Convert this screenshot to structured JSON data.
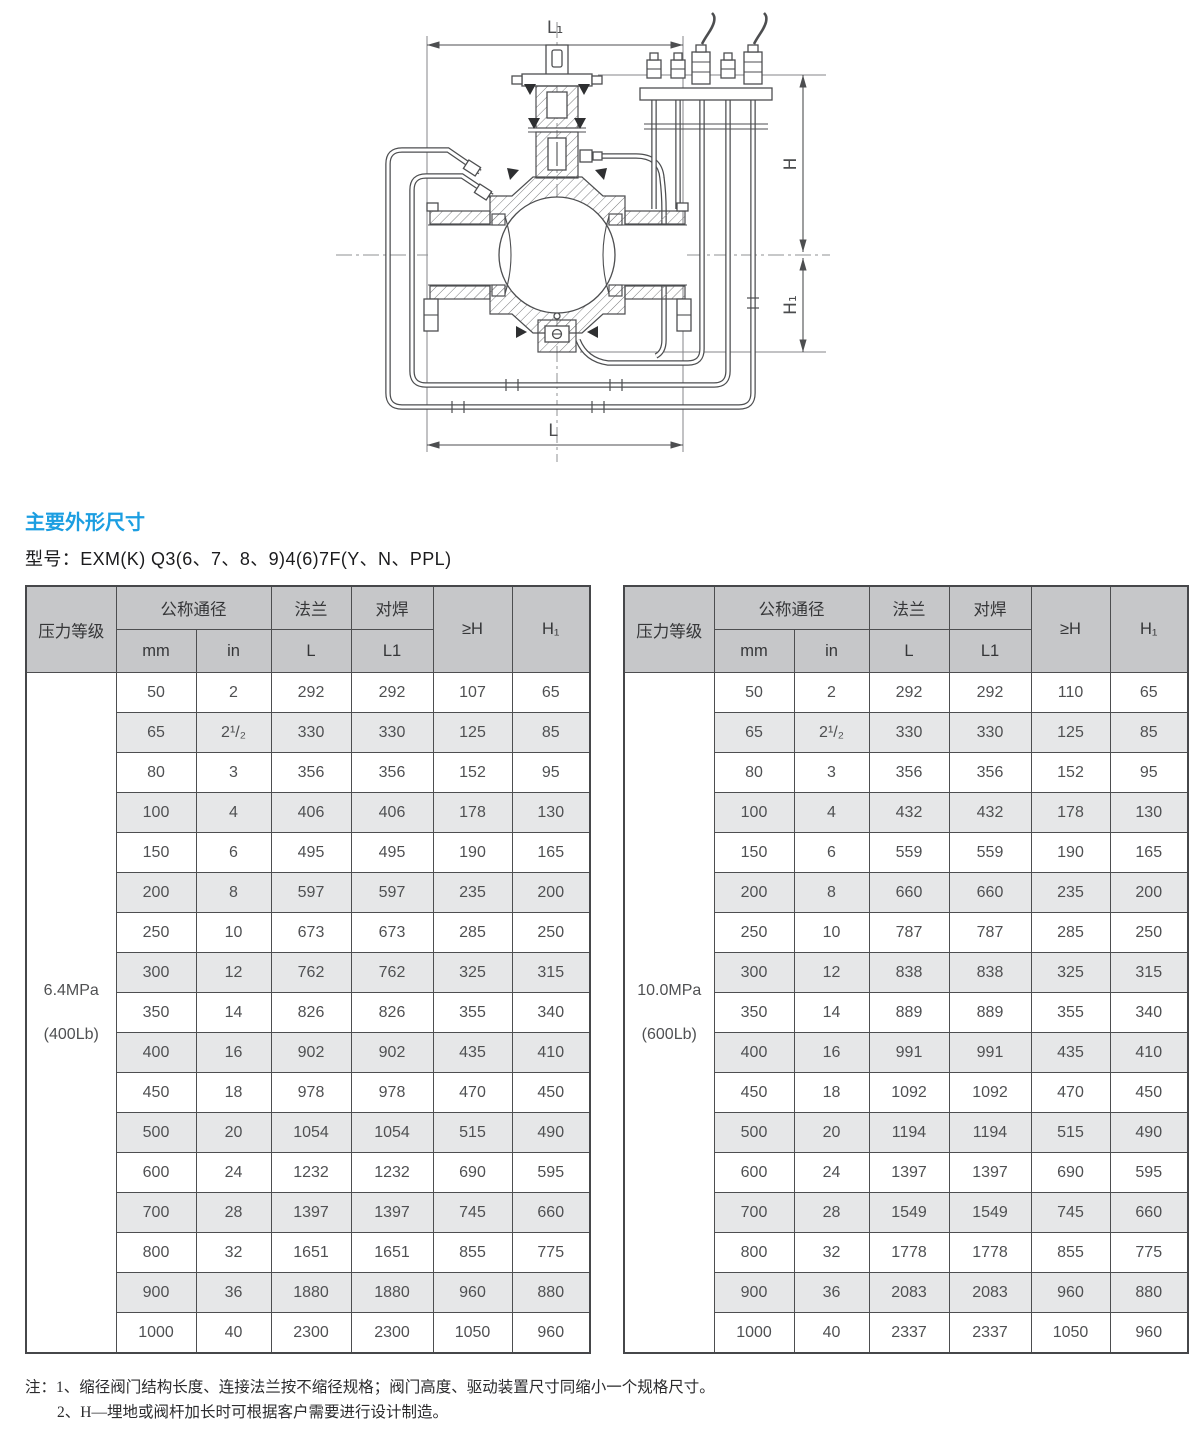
{
  "page": {
    "heading": "主要外形尺寸",
    "model_label": "型号：EXM(K) Q3(6、7、8、9)4(6)7F(Y、N、PPL)",
    "notes_prefix": "注：",
    "notes": [
      "1、缩径阀门结构长度、连接法兰按不缩径规格；阀门高度、驱动装置尺寸同缩小一个规格尺寸。",
      "2、H—埋地或阀杆加长时可根据客户需要进行设计制造。"
    ]
  },
  "colors": {
    "accent_blue": "#1c9ee1",
    "table_header_gray": "#c6c7c9",
    "table_alt_row_gray": "#e6e7e8"
  },
  "drawing": {
    "labels": {
      "l1": "L₁",
      "h": "H",
      "h1": "H₁",
      "l": "L"
    }
  },
  "table_headers": {
    "pressure": "压力等级",
    "dn": "公称通径",
    "dn_mm": "mm",
    "dn_in": "in",
    "flange": "法兰",
    "flange_l": "L",
    "weld": "对焊",
    "weld_l1": "L1",
    "h": "≥H",
    "h1": "H₁"
  },
  "tables": [
    {
      "pressure_line1": "6.4MPa",
      "pressure_line2": "(400Lb)",
      "rows": [
        [
          "50",
          "2",
          "292",
          "292",
          "107",
          "65"
        ],
        [
          "65",
          "2¹/₂",
          "330",
          "330",
          "125",
          "85"
        ],
        [
          "80",
          "3",
          "356",
          "356",
          "152",
          "95"
        ],
        [
          "100",
          "4",
          "406",
          "406",
          "178",
          "130"
        ],
        [
          "150",
          "6",
          "495",
          "495",
          "190",
          "165"
        ],
        [
          "200",
          "8",
          "597",
          "597",
          "235",
          "200"
        ],
        [
          "250",
          "10",
          "673",
          "673",
          "285",
          "250"
        ],
        [
          "300",
          "12",
          "762",
          "762",
          "325",
          "315"
        ],
        [
          "350",
          "14",
          "826",
          "826",
          "355",
          "340"
        ],
        [
          "400",
          "16",
          "902",
          "902",
          "435",
          "410"
        ],
        [
          "450",
          "18",
          "978",
          "978",
          "470",
          "450"
        ],
        [
          "500",
          "20",
          "1054",
          "1054",
          "515",
          "490"
        ],
        [
          "600",
          "24",
          "1232",
          "1232",
          "690",
          "595"
        ],
        [
          "700",
          "28",
          "1397",
          "1397",
          "745",
          "660"
        ],
        [
          "800",
          "32",
          "1651",
          "1651",
          "855",
          "775"
        ],
        [
          "900",
          "36",
          "1880",
          "1880",
          "960",
          "880"
        ],
        [
          "1000",
          "40",
          "2300",
          "2300",
          "1050",
          "960"
        ]
      ]
    },
    {
      "pressure_line1": "10.0MPa",
      "pressure_line2": "(600Lb)",
      "rows": [
        [
          "50",
          "2",
          "292",
          "292",
          "110",
          "65"
        ],
        [
          "65",
          "2¹/₂",
          "330",
          "330",
          "125",
          "85"
        ],
        [
          "80",
          "3",
          "356",
          "356",
          "152",
          "95"
        ],
        [
          "100",
          "4",
          "432",
          "432",
          "178",
          "130"
        ],
        [
          "150",
          "6",
          "559",
          "559",
          "190",
          "165"
        ],
        [
          "200",
          "8",
          "660",
          "660",
          "235",
          "200"
        ],
        [
          "250",
          "10",
          "787",
          "787",
          "285",
          "250"
        ],
        [
          "300",
          "12",
          "838",
          "838",
          "325",
          "315"
        ],
        [
          "350",
          "14",
          "889",
          "889",
          "355",
          "340"
        ],
        [
          "400",
          "16",
          "991",
          "991",
          "435",
          "410"
        ],
        [
          "450",
          "18",
          "1092",
          "1092",
          "470",
          "450"
        ],
        [
          "500",
          "20",
          "1194",
          "1194",
          "515",
          "490"
        ],
        [
          "600",
          "24",
          "1397",
          "1397",
          "690",
          "595"
        ],
        [
          "700",
          "28",
          "1549",
          "1549",
          "745",
          "660"
        ],
        [
          "800",
          "32",
          "1778",
          "1778",
          "855",
          "775"
        ],
        [
          "900",
          "36",
          "2083",
          "2083",
          "960",
          "880"
        ],
        [
          "1000",
          "40",
          "2337",
          "2337",
          "1050",
          "960"
        ]
      ]
    }
  ]
}
